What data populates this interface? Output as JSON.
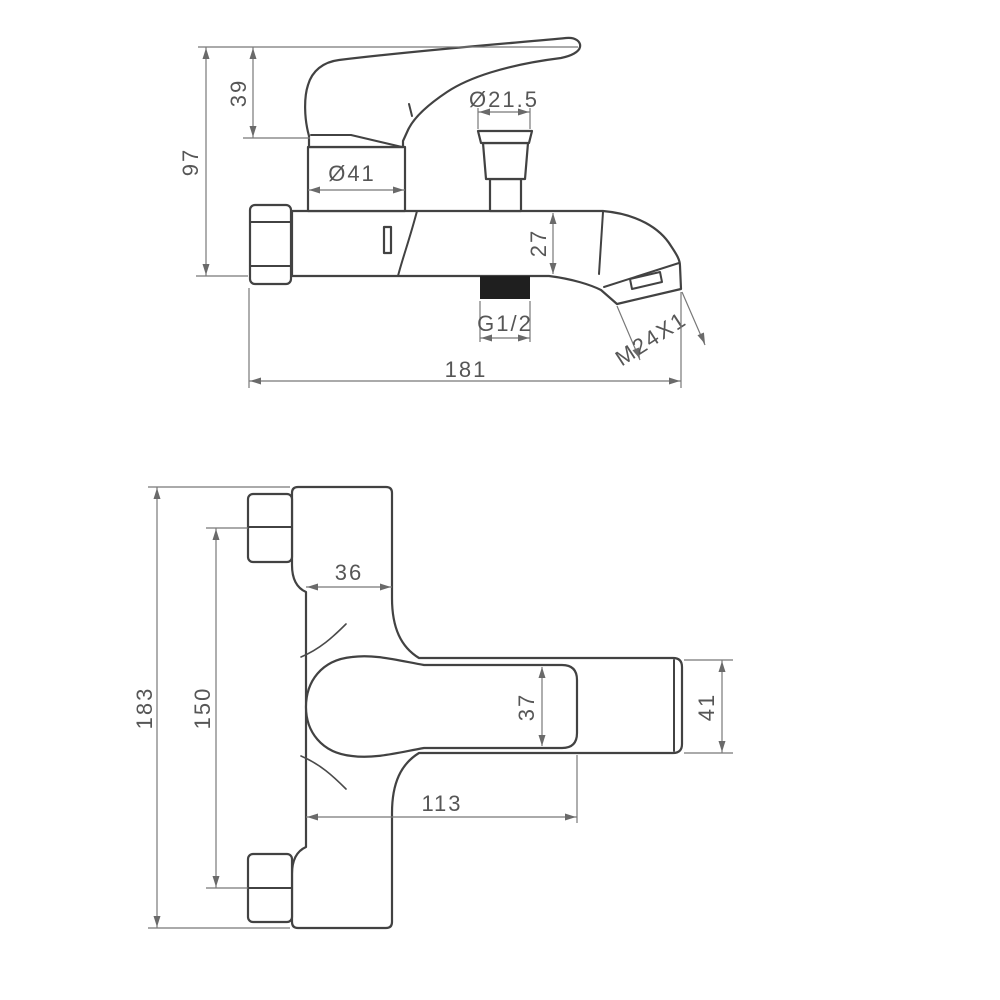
{
  "drawing": {
    "kind": "faucet-technical-drawing",
    "background": "#ffffff",
    "object_line_color": "#424242",
    "dimension_line_color": "#787878",
    "text_color": "#565656",
    "inlet_block_color": "#1f1f1f",
    "side_view": {
      "dims": {
        "handle_height": "39",
        "overall_height": "97",
        "cartridge_diameter": "Ø41",
        "diverter_diameter": "Ø21.5",
        "body_height": "27",
        "inlet_thread": "G1/2",
        "spout_thread": "M24X1",
        "overall_length": "181"
      }
    },
    "plan_view": {
      "dims": {
        "overall_width": "183",
        "inlet_centers": "150",
        "body_depth": "36",
        "handle_end_width": "37",
        "spout_end_width": "41",
        "spout_projection": "113"
      }
    }
  }
}
